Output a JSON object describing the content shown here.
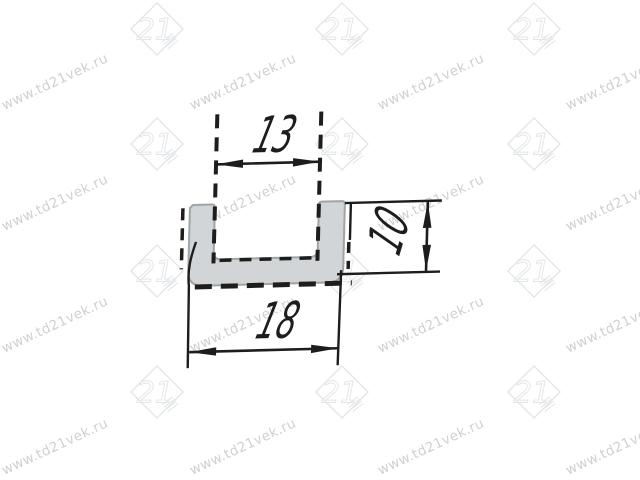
{
  "page": {
    "background": "#ffffff"
  },
  "watermark": {
    "text": "www.td21vek.ru",
    "logo_text": "21",
    "text_color": "#ced1d3",
    "logo_color": "#e3e6e8"
  },
  "drawing": {
    "subject": "U-channel profile cross-section",
    "dimensions": {
      "inner_width": "13",
      "outer_width": "18",
      "height": "10"
    },
    "colors": {
      "line": "#1d1d1d",
      "profile_fill": "#d2d5d7",
      "profile_outline": "#9fa4a7"
    }
  }
}
